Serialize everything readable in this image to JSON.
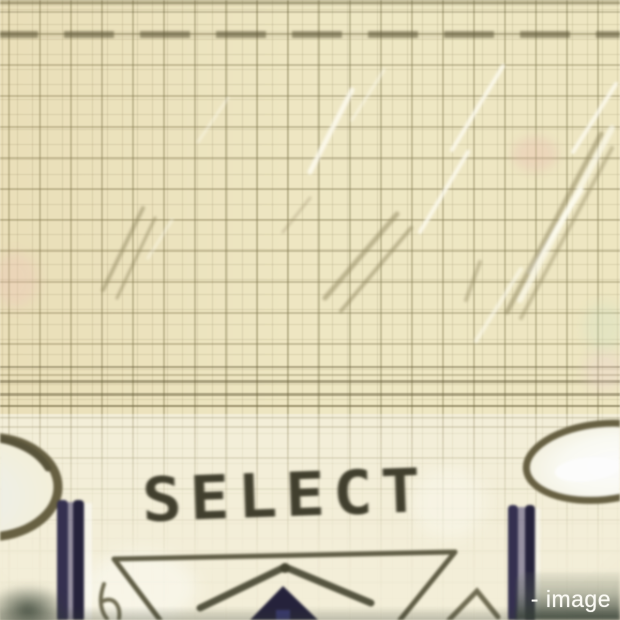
{
  "image": {
    "select_label": "SELECT",
    "watermark_text": "- image"
  },
  "colors": {
    "paper": "#efe7c2",
    "paper_light": "#f3eed8",
    "grid_line": "#8d845c",
    "ink_dark": "#403e2d",
    "line_olive": "#5f5c45",
    "navy_bar": "#232039",
    "oval_outline": "#665f42",
    "highlight_white": "#fbfaf4",
    "band_green": "#3a443a"
  }
}
